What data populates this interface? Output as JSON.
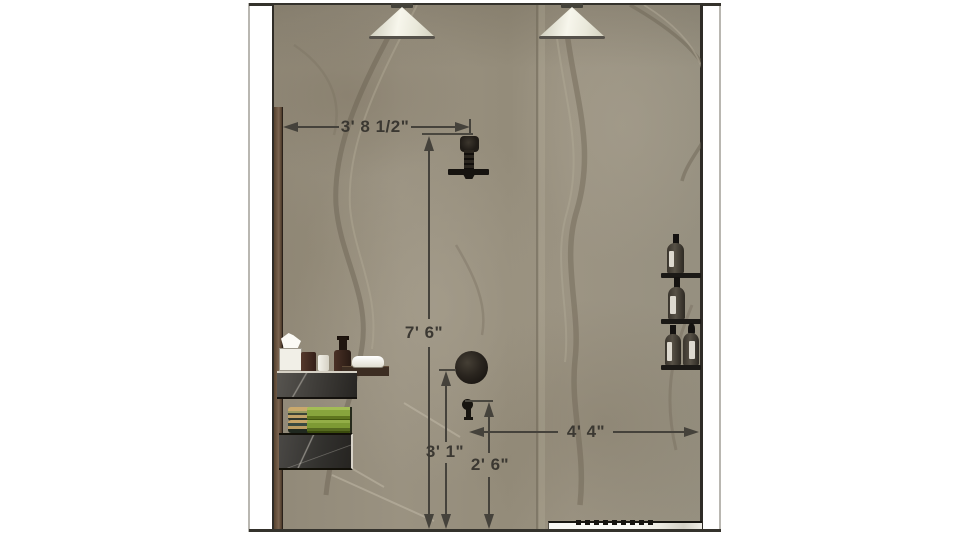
{
  "drawing": {
    "kind": "shower-wall-elevation"
  },
  "dims": {
    "head_offset": {
      "label": "3' 8 1/2\""
    },
    "head_height": {
      "label": "7' 6\""
    },
    "valve_height": {
      "label": "3' 1\""
    },
    "handle_height": {
      "label": "2' 6\""
    },
    "handle_to_wall": {
      "label": "4' 4\""
    }
  },
  "objects": {
    "lights": [
      "pendant-cone-light",
      "pendant-cone-light"
    ],
    "plumbing": [
      "shower-head",
      "mixer-valve-dial",
      "shower-handle"
    ],
    "right_wall_shelves": {
      "count": 3,
      "items": [
        "bottle",
        "bottle",
        "bottle",
        "bottle"
      ]
    },
    "vanity": [
      "tissue-box",
      "canister",
      "cup",
      "pump-bottle",
      "soap-dish",
      "towel",
      "towel",
      "marble-counter",
      "marble-cabinet"
    ],
    "floor": [
      "bench-with-drain-slots"
    ]
  },
  "colors": {
    "wall_base": "#968e7d",
    "trim_brown": "#6f5a45",
    "slab_dark": "#3a3836",
    "towel_green": "#85a139",
    "dimension_line": "#45423b",
    "lamp_shade": "#f2f1e6"
  }
}
